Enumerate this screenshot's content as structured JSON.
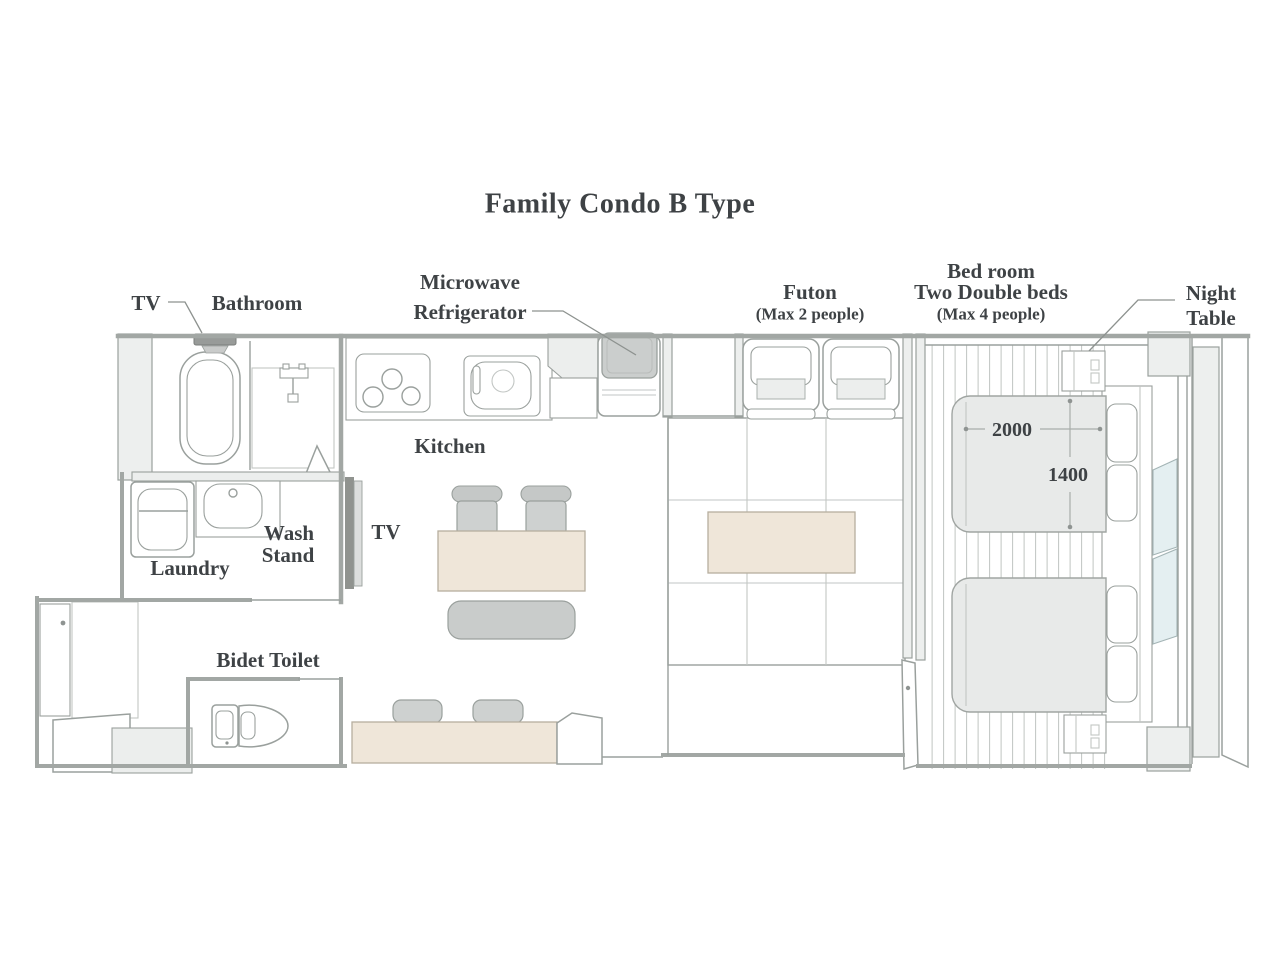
{
  "title": "Family Condo B Type",
  "labels": {
    "tv_bathroom": "TV",
    "bathroom": "Bathroom",
    "microwave": "Microwave",
    "refrigerator": "Refrigerator",
    "kitchen": "Kitchen",
    "tv_living": "TV",
    "wash_stand_line1": "Wash",
    "wash_stand_line2": "Stand",
    "laundry": "Laundry",
    "bidet_toilet": "Bidet Toilet",
    "futon": "Futon",
    "futon_capacity": "(Max 2 people)",
    "bedroom_line1": "Bed room",
    "bedroom_line2": "Two Double beds",
    "bedroom_capacity": "(Max 4 people)",
    "night_table_line1": "Night",
    "night_table_line2": "Table"
  },
  "dimensions": {
    "bed_length_mm": "2000",
    "bed_width_mm": "1400"
  },
  "colors": {
    "text": "#3e4245",
    "wall_line": "#a2a7a4",
    "wall_fill": "#edefee",
    "counter_beige": "#efe6d9",
    "furniture_gray": "#ced1d0",
    "bed_gray": "#e8eae9",
    "appliance_gray": "#cbcecd",
    "tv_dark": "#90938f",
    "window_blue": "#e4eff1"
  }
}
